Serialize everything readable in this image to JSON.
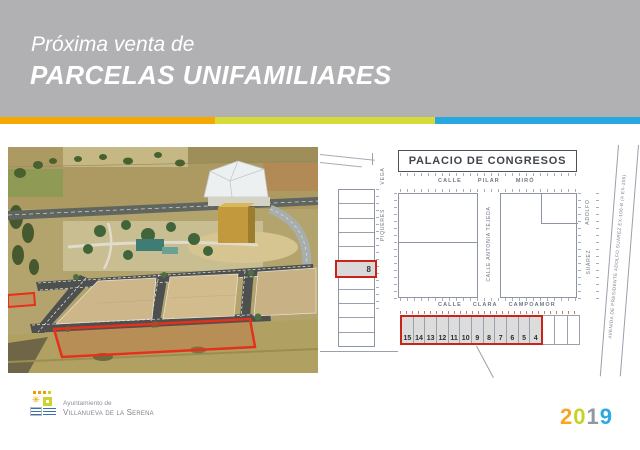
{
  "header": {
    "subtitle": "Próxima venta de",
    "title": "PARCELAS UNIFAMILIARES",
    "bg": "#b1b1b3",
    "stripe_colors": [
      "#F5A800",
      "#D6DB39",
      "#29A8E0"
    ]
  },
  "map": {
    "building_label": "PALACIO DE CONGRESOS",
    "streets": {
      "pilar_miro": [
        "CALLE",
        "PILAR",
        "MIRÓ"
      ],
      "clara_campoamor": [
        "CALLE",
        "CLARA",
        "CAMPOAMOR"
      ],
      "antonia_tejeda": "CALLE  ANTONIA TEJEDA",
      "vega": "VEGA",
      "piqueres": "PIQUERES",
      "adolfo": "ADOLFO",
      "suarez": "SUÁREZ",
      "avenida": "AVENIDA DE PRESIDENTE ADOLFO SUÁREZ   EX-106-B (A EX-106)"
    },
    "highlighted_plot_left": "8",
    "bottom_plots": [
      "15",
      "14",
      "13",
      "12",
      "11",
      "10",
      "9",
      "8",
      "7",
      "6",
      "5",
      "4"
    ],
    "unnumbered_plots_right": 3,
    "left_column_rows": 11,
    "highlight_color": "#C9231A"
  },
  "footer": {
    "logo_line1": "Ayuntamiento de",
    "logo_line2": "Villanueva de la Serena",
    "icons": {
      "flower": "✳"
    },
    "year": {
      "digits": [
        "2",
        "0",
        "1",
        "9"
      ],
      "colors": [
        "#F5A623",
        "#C5D226",
        "#93989E",
        "#2BA9E0"
      ]
    }
  }
}
